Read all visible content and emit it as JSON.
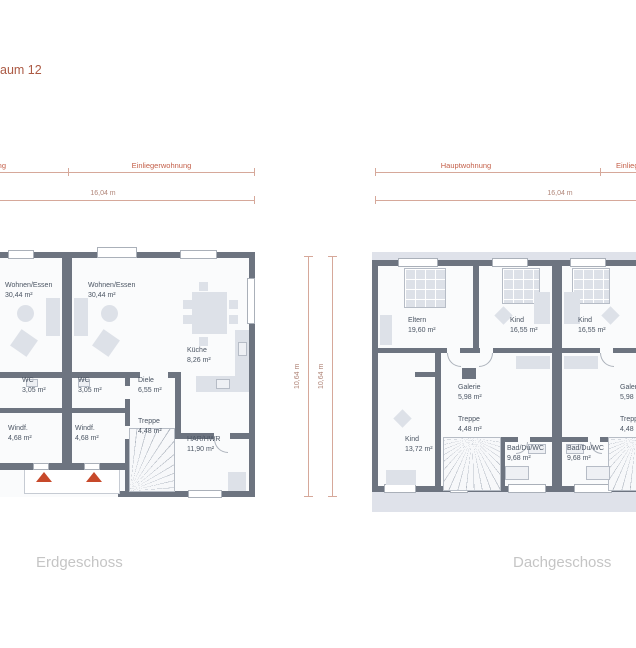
{
  "title_fragment": "aum 12",
  "colors": {
    "wall": "#6d7480",
    "floor": "#fafbfc",
    "band": "#dfe2ea",
    "furniture": "#dde1e8",
    "accent-red": "#c4604a",
    "dim-line": "#d6a89a",
    "measure-text": "#b08578",
    "label-text": "#4b5563",
    "caption-gray": "#c5c5c5",
    "arrow-orange": "#c7492a",
    "title-red": "#ac5a44"
  },
  "plans": {
    "er": {
      "caption": "Erdgeschoss",
      "zone_left": "Hauptwohnung",
      "zone_right": "Einliegerwohnung",
      "width": "16,04 m",
      "height": "10,64 m",
      "rooms": {
        "we1": {
          "name": "Wohnen/Essen",
          "area": "30,44 m²"
        },
        "we2": {
          "name": "Wohnen/Essen",
          "area": "30,44 m²"
        },
        "wc1": {
          "name": "WC",
          "area": "3,05 m²"
        },
        "wc2": {
          "name": "WC",
          "area": "3,05 m²"
        },
        "diele": {
          "name": "Diele",
          "area": "6,55 m²"
        },
        "kueche": {
          "name": "Küche",
          "area": "8,26 m²"
        },
        "treppe": {
          "name": "Treppe",
          "area": "4,48 m²"
        },
        "windf1": {
          "name": "Windf.",
          "area": "4,68 m²"
        },
        "windf2": {
          "name": "Windf.",
          "area": "4,68 m²"
        },
        "har": {
          "name": "HAR/HWR",
          "area": "11,90 m²"
        }
      }
    },
    "dg": {
      "caption": "Dachgeschoss",
      "zone_left": "Hauptwohnung",
      "zone_right": "Einliegerwohnung",
      "width": "16,04 m",
      "height": "10,64 m",
      "rooms": {
        "eltern": {
          "name": "Eltern",
          "area": "19,60 m²"
        },
        "kind1": {
          "name": "Kind",
          "area": "16,55 m²"
        },
        "kind2": {
          "name": "Kind",
          "area": "16,55 m²"
        },
        "galerie": {
          "name": "Galerie",
          "area": "5,98 m²"
        },
        "treppe": {
          "name": "Treppe",
          "area": "4,48 m²"
        },
        "kind3": {
          "name": "Kind",
          "area": "13,72 m²"
        },
        "bad1": {
          "name": "Bad/Du/WC",
          "area": "9,68 m²"
        },
        "bad2": {
          "name": "Bad/Du/WC",
          "area": "9,68 m²"
        },
        "galerie2": {
          "name": "Galerie",
          "area": "5,98 m²"
        },
        "treppe2": {
          "name": "Treppe",
          "area": "4,48 m²"
        }
      }
    }
  }
}
